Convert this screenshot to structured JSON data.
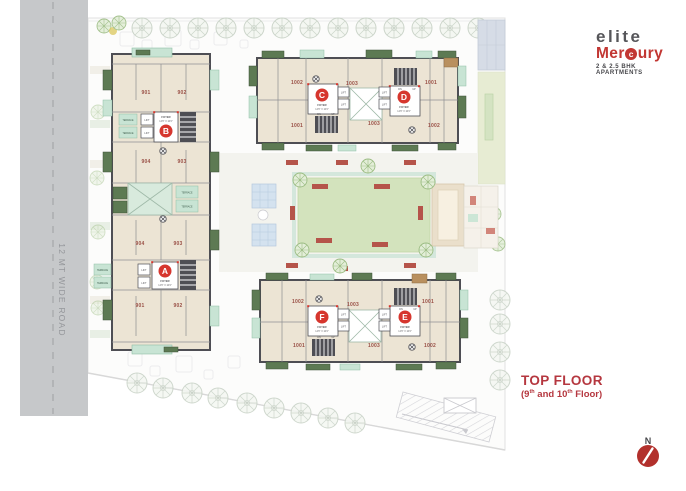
{
  "logo": {
    "name_top": "elite",
    "name_mid_pre": "Mer",
    "name_mid_c": "c",
    "name_mid_post": "ury",
    "tagline": "2 & 2.5 BHK APARTMENTS"
  },
  "title": {
    "main": "TOP FLOOR",
    "paren_open": "(9",
    "sup_a": "th",
    "mid": " and 10",
    "sup_b": "th",
    "tail": " Floor)"
  },
  "road": {
    "label": "12 MT WIDE ROAD"
  },
  "north": {
    "label": "N"
  },
  "labels": {
    "lift": "LIFT",
    "terrace": "TERRACE",
    "foyer": "FOYER",
    "foyer_dims": "14'6\" X 10'0\"",
    "dn": "DN",
    "up": "UP"
  },
  "cores": {
    "a": "A",
    "b": "B",
    "c": "C",
    "d": "D",
    "e": "E",
    "f": "F"
  },
  "units": {
    "b_tl": "901",
    "b_tr": "902",
    "b_bl": "904",
    "b_br": "903",
    "a_tl": "904",
    "a_tr": "903",
    "a_bl": "901",
    "a_br": "902",
    "t_tl": "1002",
    "t_tm": "1003",
    "t_tr": "1001",
    "t_bl": "1001",
    "t_bm": "1003",
    "t_br": "1002",
    "bb_tl": "1002",
    "bb_tm": "1003",
    "bb_tr": "1001",
    "bb_bl": "1001",
    "bb_bm": "1003",
    "bb_br": "1002"
  },
  "colors": {
    "accent_red": "#d6362e",
    "brand_red": "#c23733",
    "title_red": "#b5373f",
    "wall": "#4e4e54",
    "road_gray": "#c6c8ca",
    "lawn_green": "#d3e3bd",
    "balcony_green": "#5d7a53",
    "terrace_mint": "#c8e4d4"
  }
}
